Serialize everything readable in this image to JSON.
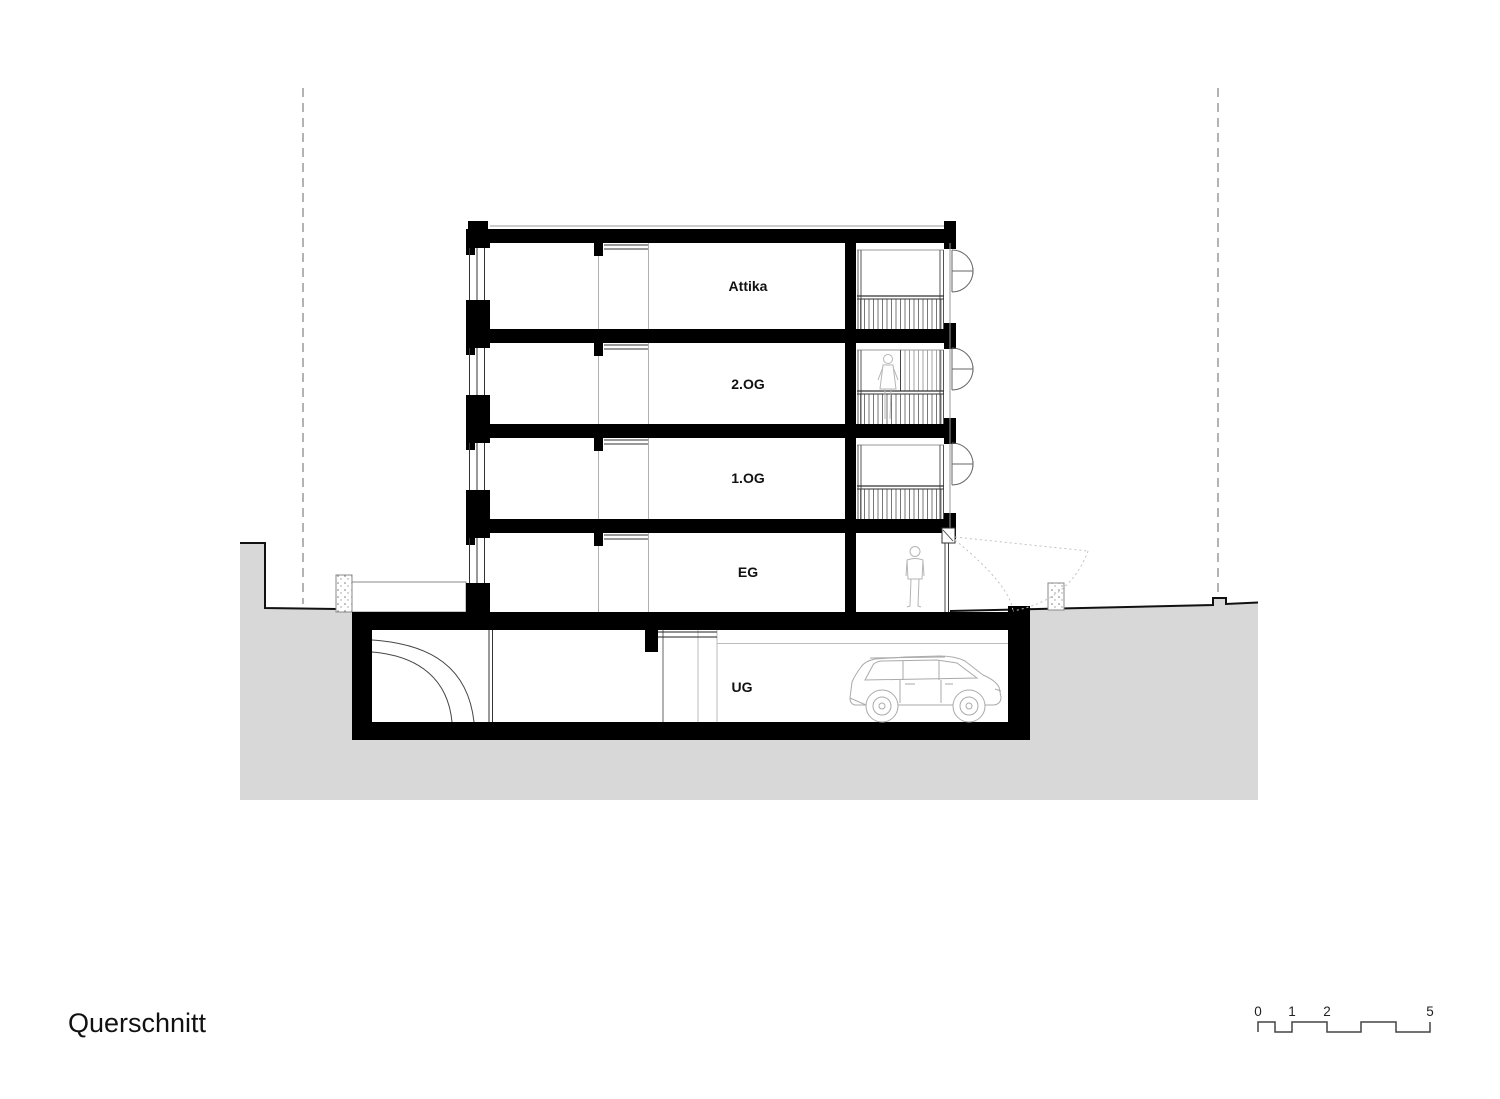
{
  "drawing": {
    "title": "Querschnitt",
    "floors": [
      {
        "label": "Attika"
      },
      {
        "label": "2.OG"
      },
      {
        "label": "1.OG"
      },
      {
        "label": "EG"
      },
      {
        "label": "UG"
      }
    ],
    "scale_bar": {
      "unit_labels": [
        "0",
        "1",
        "2",
        "5"
      ]
    },
    "colors": {
      "ink": "#000000",
      "terrain_fill": "#d8d8d8",
      "detail_line": "#999999",
      "figure_line": "#b3b3b3"
    }
  }
}
